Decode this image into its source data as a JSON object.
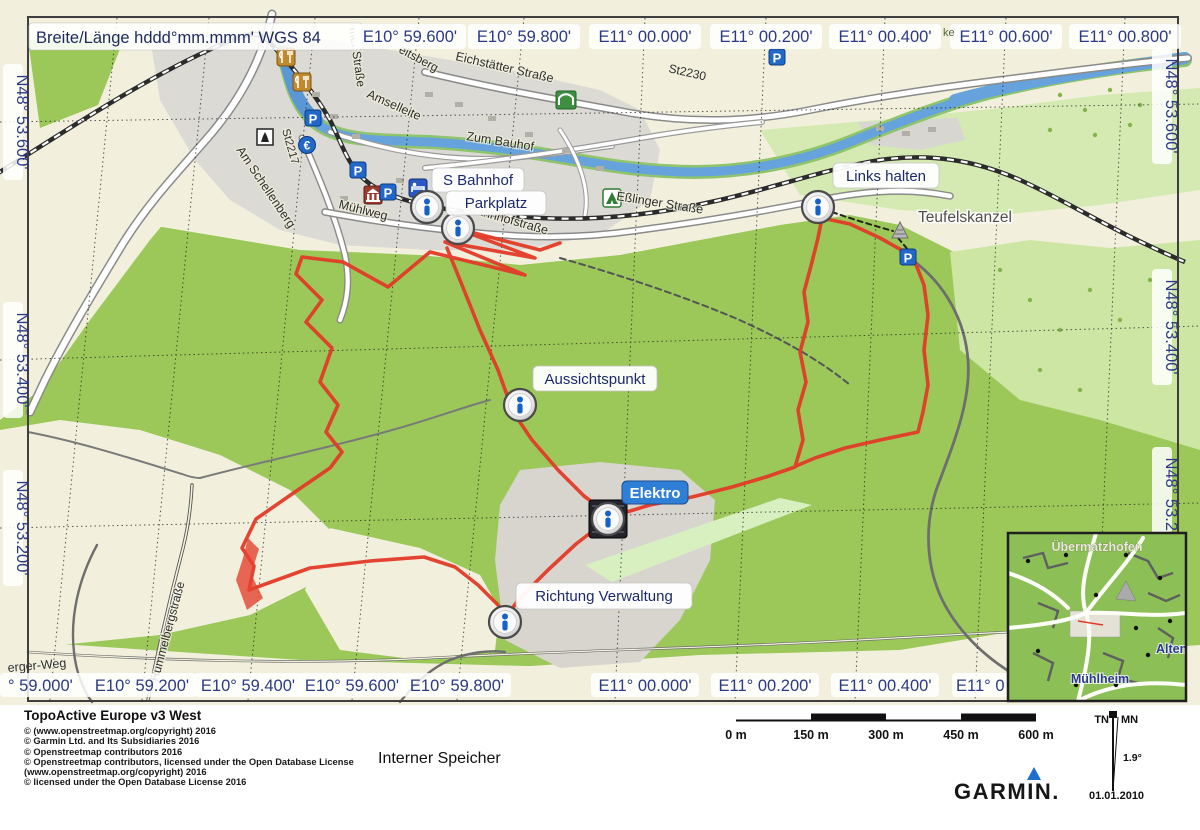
{
  "header": {
    "coordinate_format": "Breite/Länge hddd°mm.mmm' WGS 84"
  },
  "grid": {
    "top": [
      "E10° 59.600'",
      "E10° 59.800'",
      "E11° 00.000'",
      "E11° 00.200'",
      "E11° 00.400'",
      "E11° 00.600'",
      "E11° 00.800'"
    ],
    "bottom": [
      "° 59.000'",
      "E10° 59.200'",
      "E10° 59.400'",
      "E10° 59.600'",
      "E10° 59.800'",
      "E11° 00.000'",
      "E11° 00.200'",
      "E11° 00.400'",
      "E11° 0"
    ],
    "left": [
      "N48° 53.600'",
      "N48° 53.400'",
      "N48° 53.200'"
    ],
    "right": [
      "N48° 53.600'",
      "N48° 53.400'",
      "N48° 53.200'"
    ]
  },
  "waypoints": {
    "s_bahnhof": "S Bahnhof",
    "parkplatz": "Parkplatz",
    "links_halten": "Links halten",
    "aussichtspunkt": "Aussichtspunkt",
    "elektro": "Elektro",
    "richtung_verwaltung": "Richtung Verwaltung"
  },
  "map_labels": {
    "teufelskanzel": "Teufelskanzel",
    "muehlweg": "Mühlweg",
    "bahnhofstrasse": "Bahnhofstraße",
    "esslinger_strasse": "Eßlinger Straße",
    "eichstaetter_strasse": "Eichstätter Straße",
    "amselleite": "Amselleite",
    "zum_bauhof": "Zum Bauhof",
    "st2230": "St2230",
    "st2217": "St2217",
    "am_schellenberg": "Am Schellenberg",
    "hummelbergstrasse": "Hummelbergstraße",
    "berger_weg": "erger-Weg",
    "eitsberg": "eitsberg",
    "mer_strasse": "mer Straße",
    "ke_fragment": "ke"
  },
  "icons": {
    "parking": "P",
    "euro": "€"
  },
  "inset": {
    "top_label": "Übermatzhofen",
    "right_label": "Alten",
    "bottom_label": "Mühlheim"
  },
  "footer": {
    "product": "TopoActive Europe v3 West",
    "copyright_lines": [
      "© (www.openstreetmap.org/copyright) 2016",
      "© Garmin Ltd. and Its Subsidiaries 2016",
      "© Openstreetmap contributors 2016",
      "© Openstreetmap contributors, licensed under the Open Database License",
      "(www.openstreetmap.org/copyright) 2016",
      "© licensed under the Open Database License 2016"
    ],
    "storage": "Interner Speicher",
    "scale_labels": [
      "0 m",
      "150 m",
      "300 m",
      "450 m",
      "600 m"
    ],
    "declination": {
      "tn": "TN",
      "mn": "MN",
      "angle": "1.9°",
      "date": "01.01.2010"
    },
    "brand": "GARMIN."
  },
  "colors": {
    "track": "#e33b28",
    "forest": "#9bc859",
    "water": "#66a3dc",
    "label_text": "#1c2a6a",
    "selected_label_bg": "#2f7fd6"
  }
}
